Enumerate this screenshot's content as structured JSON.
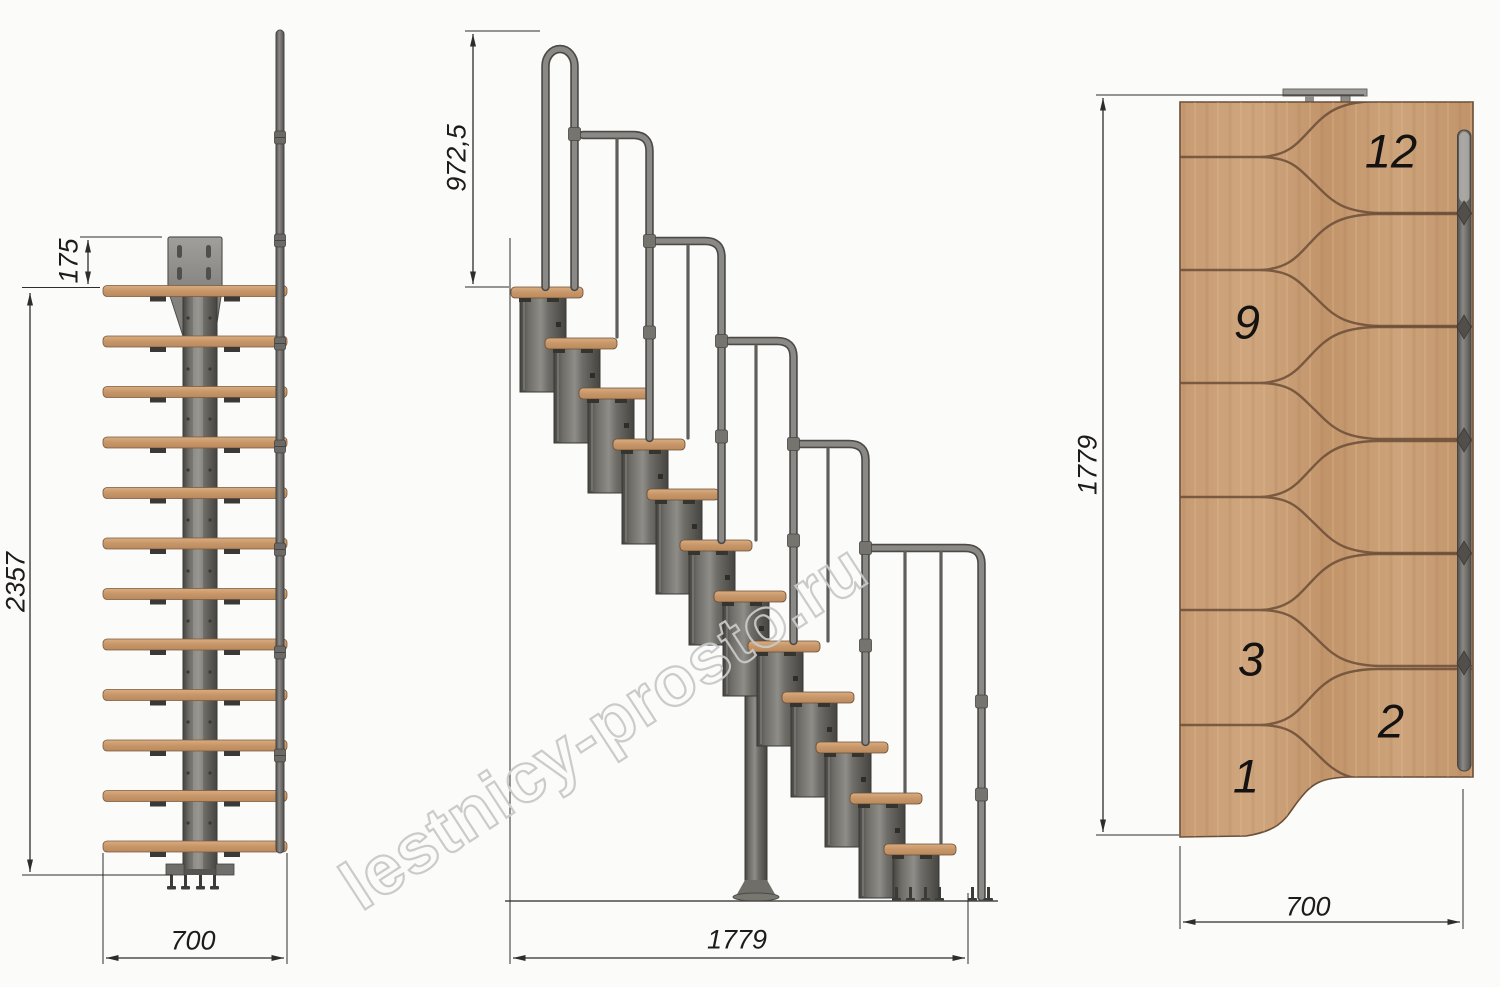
{
  "watermark_text": "lestnicy-prosto.ru",
  "front_view": {
    "dim_plate_offset": "175",
    "dim_total_height": "2357",
    "dim_width": "700"
  },
  "side_view": {
    "dim_handrail_height": "972,5",
    "dim_total_length": "1779"
  },
  "plan_view": {
    "dim_total_length": "1779",
    "dim_width": "700",
    "step_numbers": {
      "top": "12",
      "upper_mid": "9",
      "lower_mid": "3",
      "second": "2",
      "first": "1"
    }
  },
  "colors": {
    "wood": "#c89c73",
    "metal_dark": "#4b4a47",
    "metal_light": "#8b8985",
    "dimension_lines": "#2e2d2b",
    "watermark": "#c9c9c9",
    "background": "#fbfbfa"
  }
}
